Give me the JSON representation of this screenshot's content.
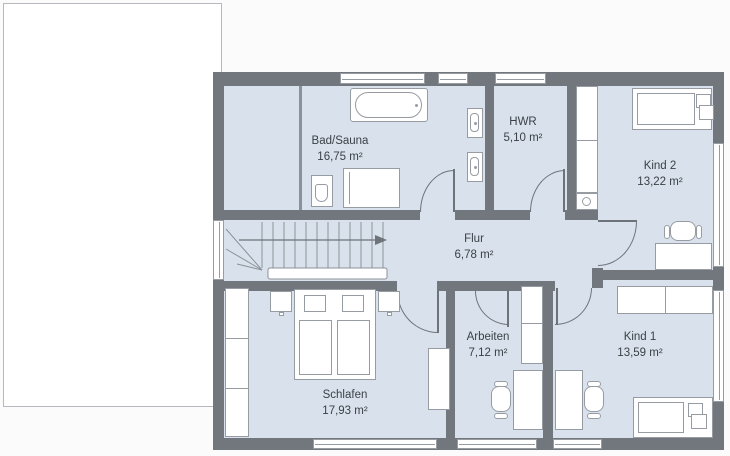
{
  "colors": {
    "wall": "#72777d",
    "floor": "#d9e2ec",
    "outline": "#979ca3",
    "door": "#6e737a",
    "text": "#3b4046",
    "bg": "#fbfbfb",
    "paper": "#ffffff",
    "paperline": "#b5b8bc",
    "thin": "#8b9198"
  },
  "rooms": [
    {
      "id": "bad-sauna",
      "name": "Bad/Sauna",
      "area": "16,75 m²"
    },
    {
      "id": "hwr",
      "name": "HWR",
      "area": "5,10 m²"
    },
    {
      "id": "kind-2",
      "name": "Kind 2",
      "area": "13,22 m²"
    },
    {
      "id": "flur",
      "name": "Flur",
      "area": "6,78 m²"
    },
    {
      "id": "arbeiten",
      "name": "Arbeiten",
      "area": "7,12 m²"
    },
    {
      "id": "kind-1",
      "name": "Kind 1",
      "area": "13,59 m²"
    },
    {
      "id": "schlafen",
      "name": "Schlafen",
      "area": "17,93 m²"
    }
  ]
}
